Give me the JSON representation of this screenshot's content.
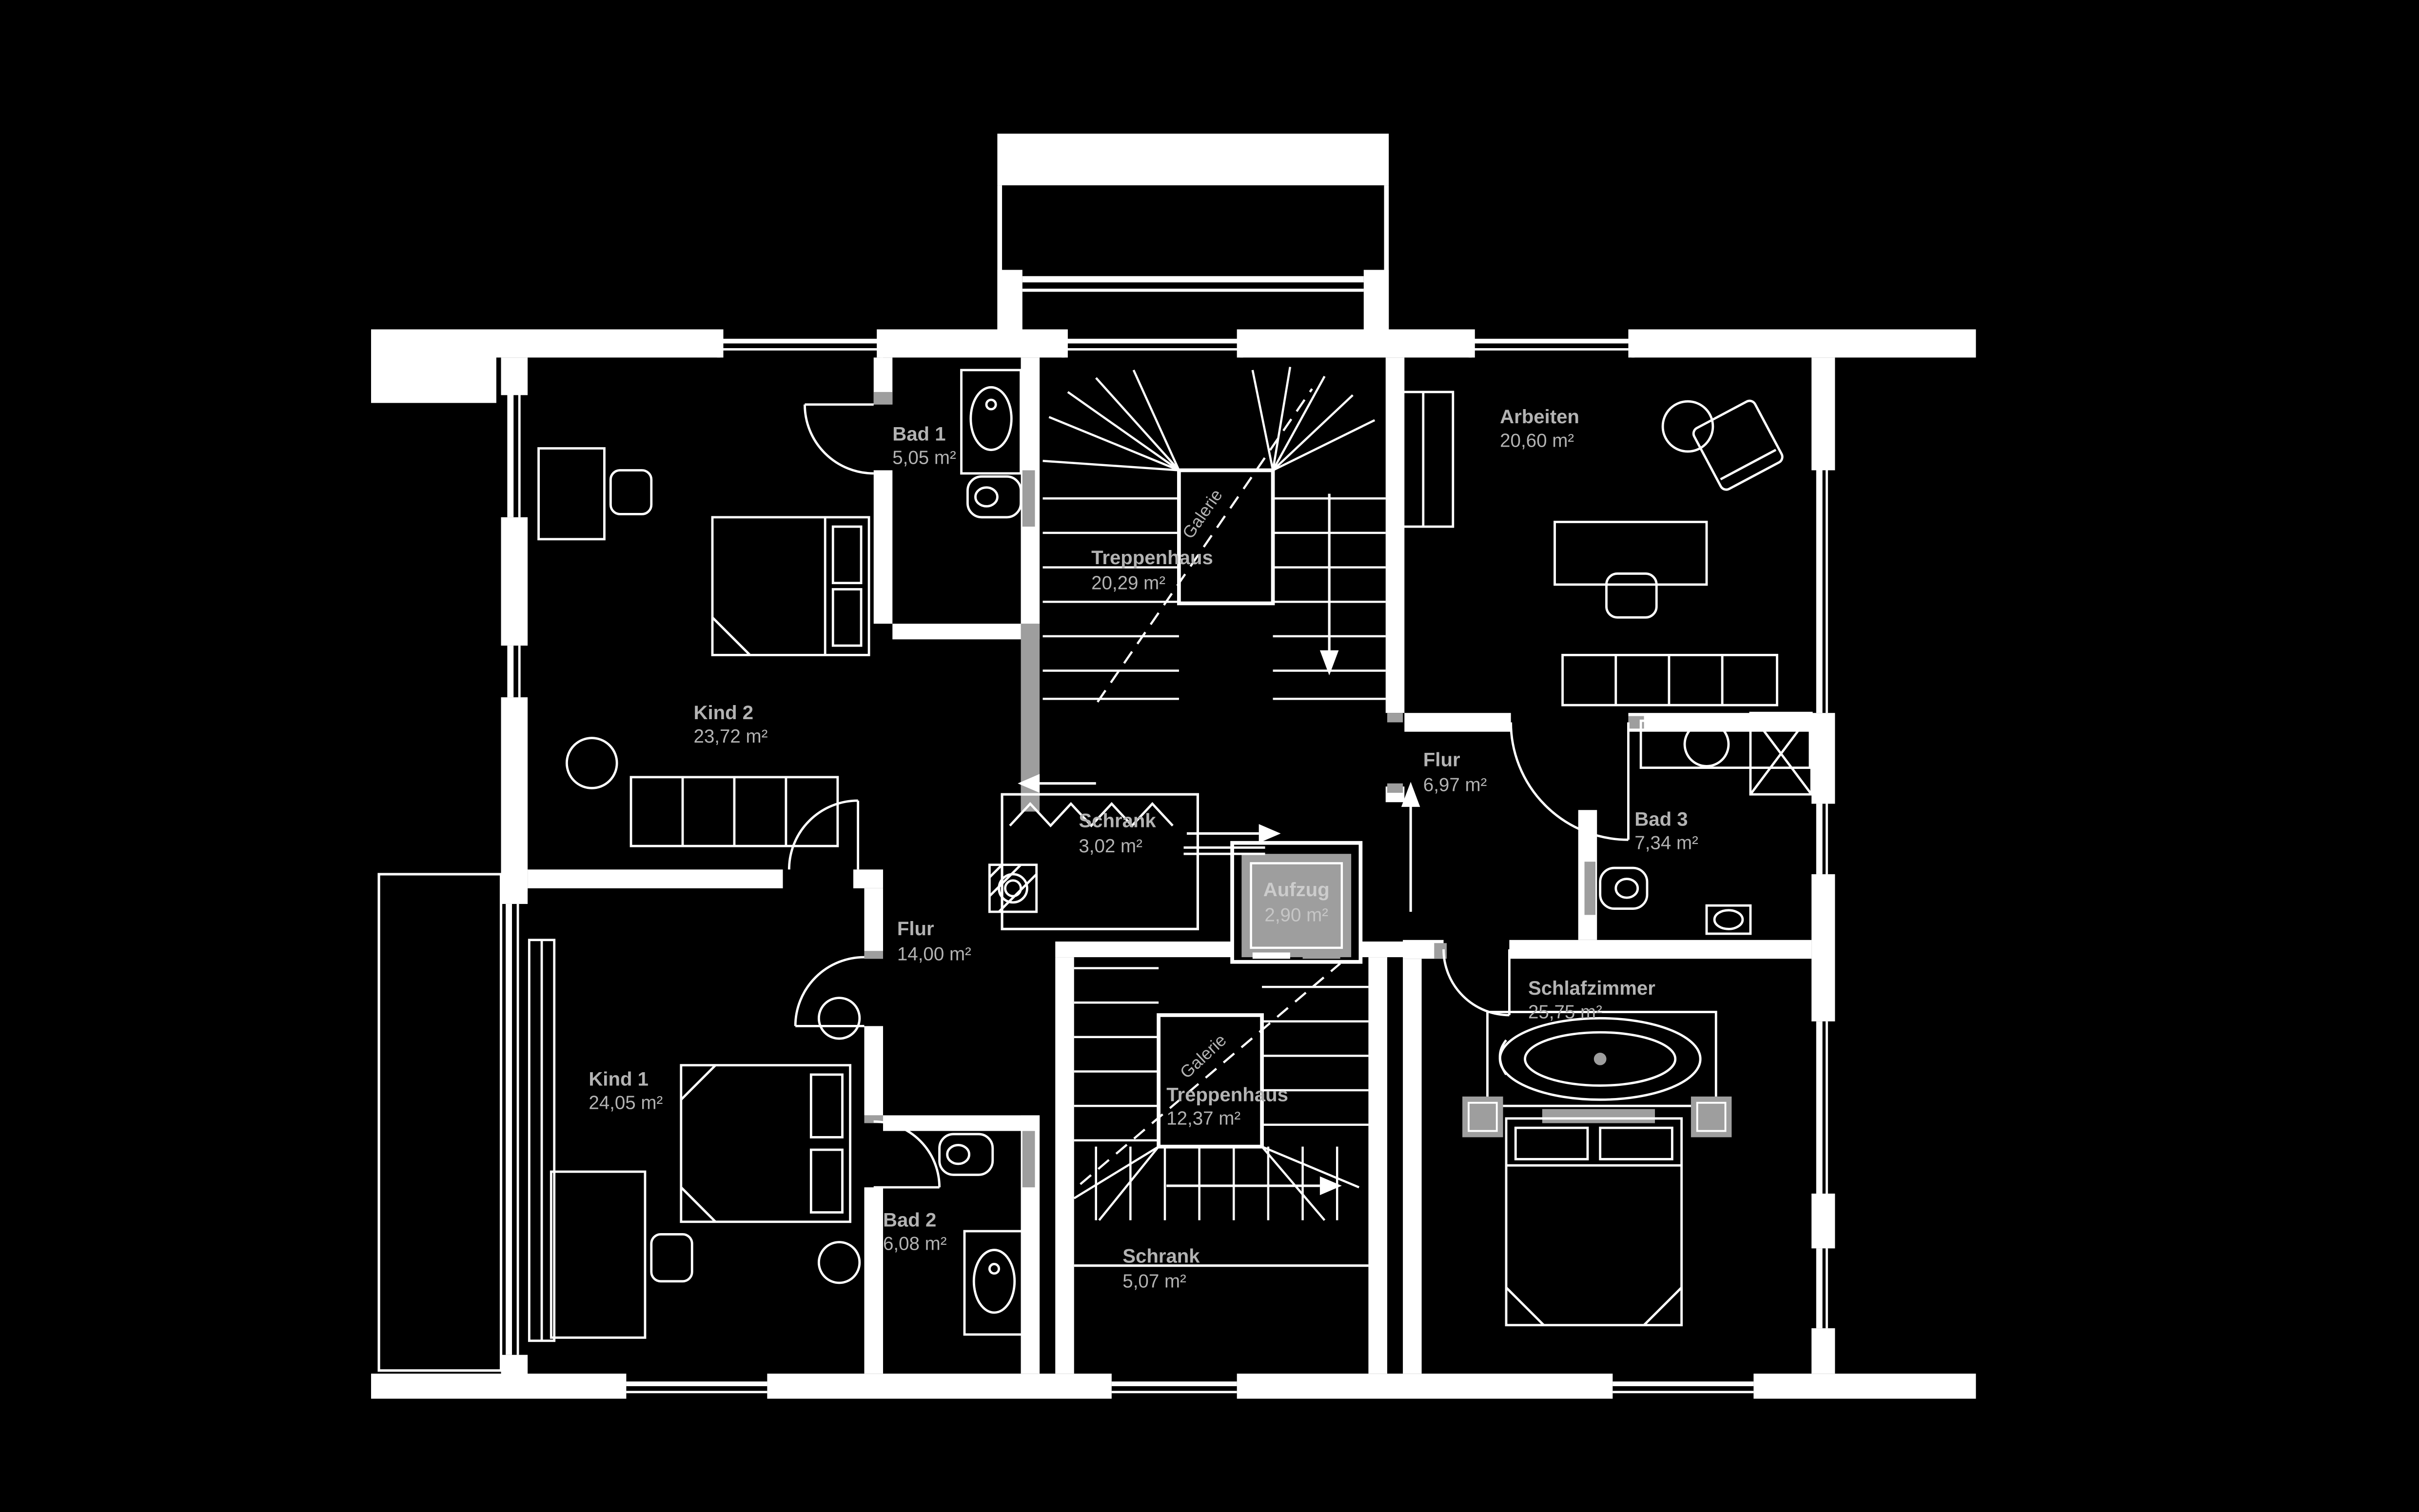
{
  "colors": {
    "background": "#000000",
    "walls": "#ffffff",
    "label_text": "#b3b3b3",
    "gray_wall": "#9e9e9e",
    "elevator_fill": "#9e9e9e",
    "elevator_text": "#cccccc"
  },
  "rooms": {
    "bad1": {
      "name": "Bad 1",
      "area": "5,05 m²"
    },
    "kind2": {
      "name": "Kind 2",
      "area": "23,72 m²"
    },
    "treppenhaus_oben": {
      "name": "Treppenhaus",
      "area": "20,29 m²"
    },
    "arbeiten": {
      "name": "Arbeiten",
      "area": "20,60 m²"
    },
    "flur_klein": {
      "name": "Flur",
      "area": "6,97 m²"
    },
    "schrank_klein": {
      "name": "Schrank",
      "area": "3,02 m²"
    },
    "aufzug": {
      "name": "Aufzug",
      "area": "2,90 m²"
    },
    "bad3": {
      "name": "Bad 3",
      "area": "7,34 m²"
    },
    "flur_gross": {
      "name": "Flur",
      "area": "14,00 m²"
    },
    "kind1": {
      "name": "Kind 1",
      "area": "24,05 m²"
    },
    "treppenhaus_unten": {
      "name": "Treppenhaus",
      "area": "12,37 m²"
    },
    "bad2": {
      "name": "Bad 2",
      "area": "6,08 m²"
    },
    "schrank_gross": {
      "name": "Schrank",
      "area": "5,07 m²"
    },
    "schlafzimmer": {
      "name": "Schlafzimmer",
      "area": "25,75 m²"
    }
  },
  "annotations": {
    "galerie_oben": "Galerie",
    "galerie_unten": "Galerie"
  }
}
